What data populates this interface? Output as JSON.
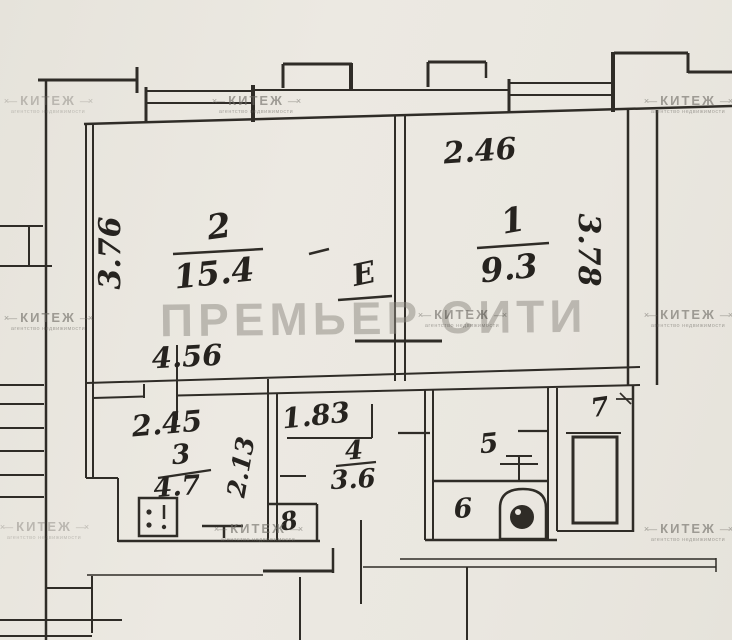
{
  "colors": {
    "paper": "#eae7e0",
    "ink": "#2f2c27",
    "watermark_brand": "#8b8780",
    "watermark_agency": "#6f6c66"
  },
  "watermarks": {
    "brand": "ПРЕМЬЕР СИТИ",
    "agency": "КИТЕЖ",
    "agency_subtitle": "агентство недвижимости"
  },
  "rooms": {
    "r1": {
      "number": "1",
      "area": "9.3"
    },
    "r2": {
      "number": "2",
      "area": "15.4"
    },
    "r3": {
      "number": "3",
      "area": "4.7"
    },
    "r4": {
      "number": "4",
      "area": "3.6"
    },
    "r5": {
      "number": "5"
    },
    "r6": {
      "number": "6"
    },
    "r7": {
      "number": "7"
    },
    "r8": {
      "number": "8"
    }
  },
  "dimensions": {
    "room1_top": "2.46",
    "room1_right": "3.78",
    "room2_left": "3.76",
    "room2_bottom": "4.56",
    "kitchen_top": "2.45",
    "kitchen_side": "2.13",
    "hallway": "1.83"
  },
  "annotations": {
    "closet": "Е"
  }
}
